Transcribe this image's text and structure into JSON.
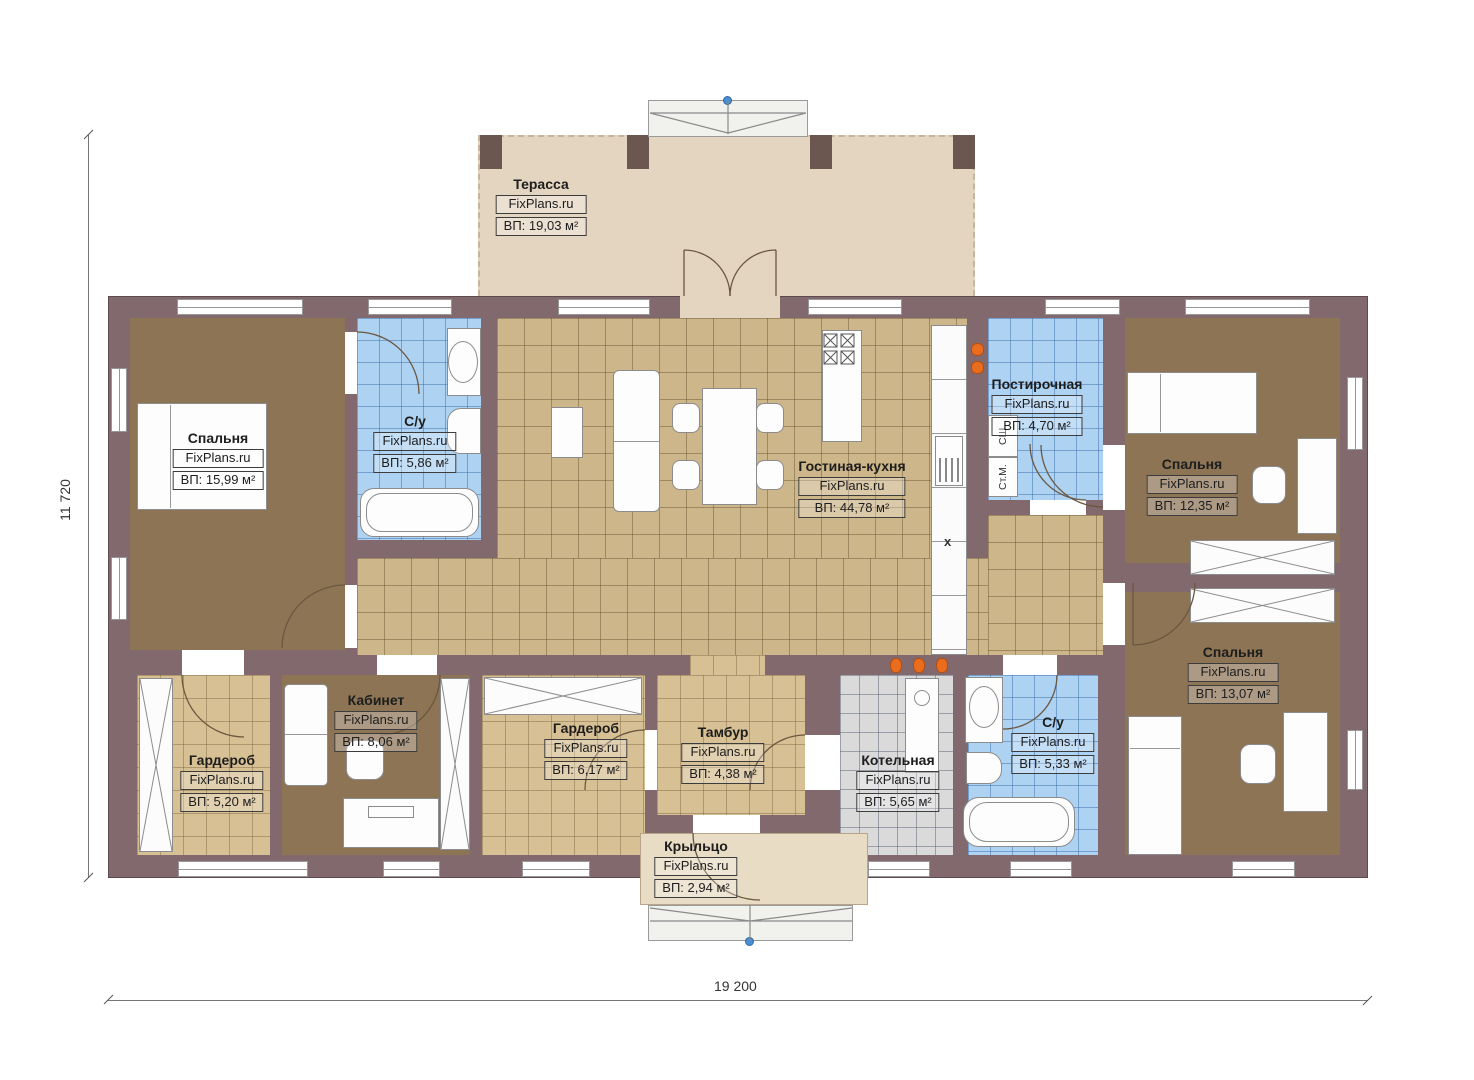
{
  "meta": {
    "type": "single-storey house floor plan"
  },
  "brand": "FixPlans.ru",
  "dimensions": {
    "height_total": "11 720",
    "width_total": "19 200"
  },
  "rooms": [
    {
      "key": "terrace",
      "name": "Терасса",
      "area": "ВП: 19,03 м²"
    },
    {
      "key": "bedroom-left",
      "name": "Спальня",
      "area": "ВП: 15,99 м²"
    },
    {
      "key": "bathroom-top",
      "name": "С/у",
      "area": "ВП: 5,86 м²"
    },
    {
      "key": "living-kitchen",
      "name": "Гостиная-кухня",
      "area": "ВП: 44,78 м²"
    },
    {
      "key": "laundry",
      "name": "Постирочная",
      "area": "ВП: 4,70 м²"
    },
    {
      "key": "bedroom-top-right",
      "name": "Спальня",
      "area": "ВП: 12,35 м²"
    },
    {
      "key": "bedroom-bottom-right",
      "name": "Спальня",
      "area": "ВП: 13,07 м²"
    },
    {
      "key": "wardrobe-left",
      "name": "Гардероб",
      "area": "ВП: 5,20 м²"
    },
    {
      "key": "office",
      "name": "Кабинет",
      "area": "ВП: 8,06 м²"
    },
    {
      "key": "wardrobe-middle",
      "name": "Гардероб",
      "area": "ВП: 6,17 м²"
    },
    {
      "key": "vestibule",
      "name": "Тамбур",
      "area": "ВП: 4,38 м²"
    },
    {
      "key": "boiler-room",
      "name": "Котельная",
      "area": "ВП: 5,65 м²"
    },
    {
      "key": "bathroom-bottom",
      "name": "С/у",
      "area": "ВП: 5,33 м²"
    },
    {
      "key": "porch",
      "name": "Крыльцо",
      "area": "ВП: 2,94 м²"
    }
  ],
  "appliance_labels": {
    "dryer": "СШ",
    "washer": "Ст.М.",
    "hob_mark": "х"
  },
  "colors": {
    "wall": "#82696e",
    "wood_floor": "#8c7455",
    "tile_tan": "#cdb689",
    "tile_blue": "#aed2f1",
    "tile_gray": "#dadada",
    "terrace": "#e4d5c0",
    "porch": "#e9dcc5",
    "accent_orange": "#ea6c1d",
    "marker_blue": "#4a8fd4"
  }
}
